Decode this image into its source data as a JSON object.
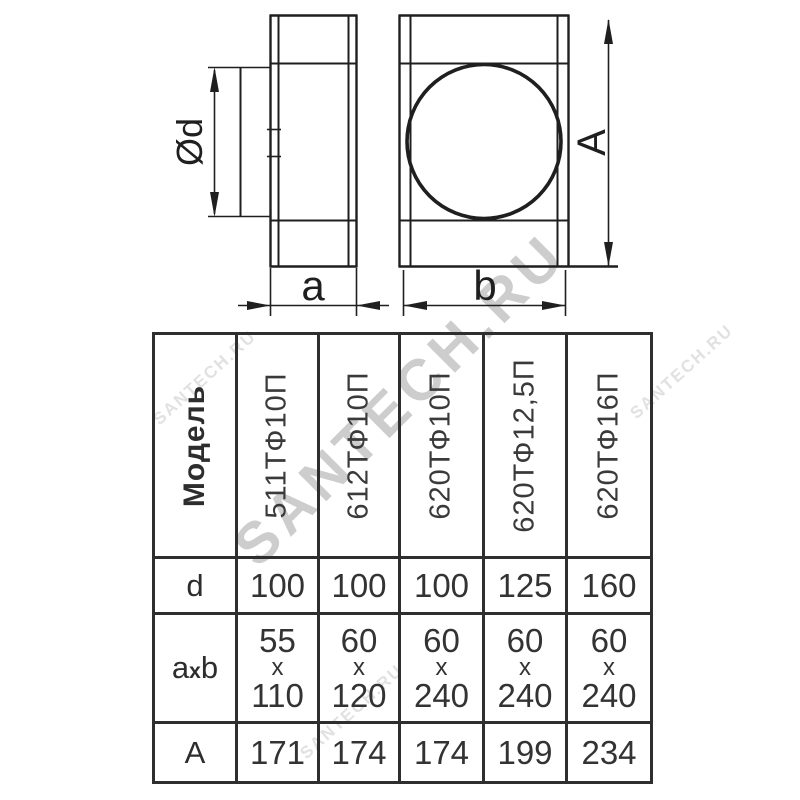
{
  "watermark": {
    "text": "SANTECH.RU"
  },
  "drawing": {
    "line_color": "#1f1f1f",
    "labels": {
      "diameter": "Ød",
      "width_a": "a",
      "width_b": "b",
      "height_A": "A"
    }
  },
  "table": {
    "header_label": "Модель",
    "models": [
      "511ТФ10П",
      "612ТФ10П",
      "620ТФ10П",
      "620ТФ12,5П",
      "620ТФ16П"
    ],
    "row_labels": {
      "d": "d",
      "axb_a": "a",
      "axb_x": "x",
      "axb_b": "b",
      "A": "A"
    },
    "x_separator": "x",
    "rows": {
      "d": [
        "100",
        "100",
        "100",
        "125",
        "160"
      ],
      "axb": [
        {
          "a": "55",
          "b": "110"
        },
        {
          "a": "60",
          "b": "120"
        },
        {
          "a": "60",
          "b": "240"
        },
        {
          "a": "60",
          "b": "240"
        },
        {
          "a": "60",
          "b": "240"
        }
      ],
      "A": [
        "171",
        "174",
        "174",
        "199",
        "234"
      ]
    }
  },
  "chart_data": {
    "type": "table",
    "title": "Соединитель каналов с фланцем — размеры",
    "columns": [
      "Модель",
      "511ТФ10П",
      "612ТФ10П",
      "620ТФ10П",
      "620ТФ12,5П",
      "620ТФ16П"
    ],
    "rows": [
      [
        "d",
        "100",
        "100",
        "100",
        "125",
        "160"
      ],
      [
        "axb",
        "55x110",
        "60x120",
        "60x240",
        "60x240",
        "60x240"
      ],
      [
        "A",
        "171",
        "174",
        "174",
        "199",
        "234"
      ]
    ]
  }
}
